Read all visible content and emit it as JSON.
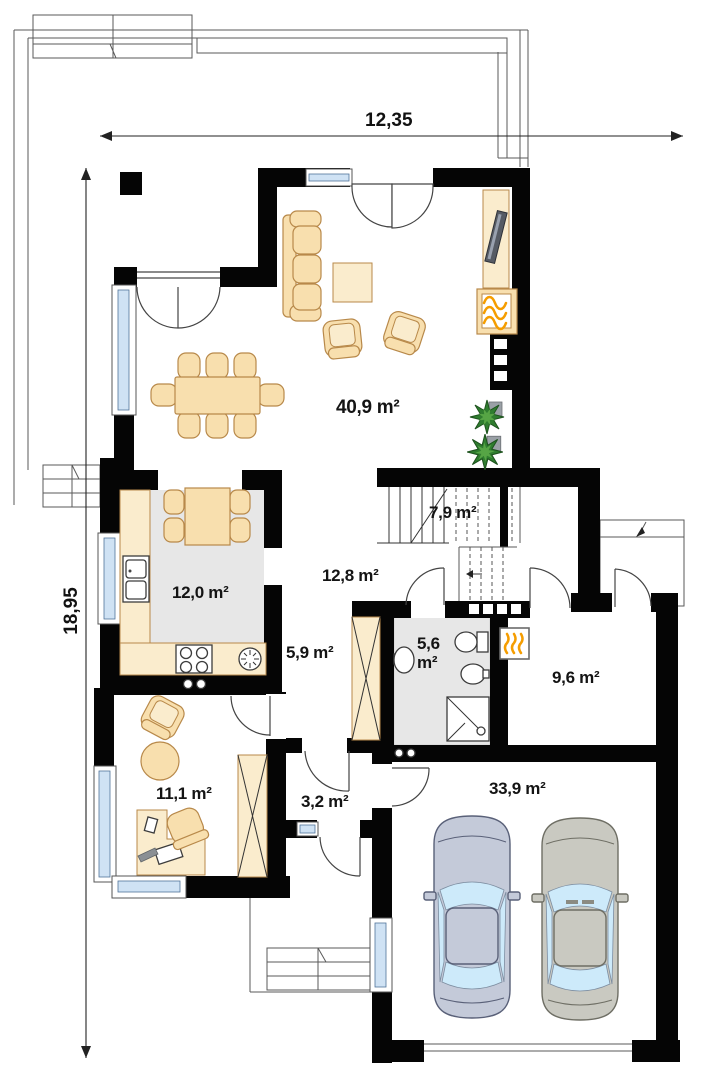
{
  "plan": {
    "type": "floor-plan",
    "dimensions": {
      "width_label": "12,35",
      "height_label": "18,95"
    },
    "rooms": [
      {
        "name": "living-room",
        "label": "40,9 m²"
      },
      {
        "name": "staircase",
        "label": "7,9 m²"
      },
      {
        "name": "hall",
        "label": "12,8 m²"
      },
      {
        "name": "kitchen",
        "label": "12,0 m²"
      },
      {
        "name": "corridor",
        "label": "5,9 m²"
      },
      {
        "name": "bathroom",
        "label": "5,6",
        "label2": "m²"
      },
      {
        "name": "utility-room",
        "label": "9,6 m²"
      },
      {
        "name": "office",
        "label": "11,1 m²"
      },
      {
        "name": "vestibule",
        "label": "3,2 m²"
      },
      {
        "name": "garage",
        "label": "33,9 m²"
      }
    ],
    "icons": [
      "fireplace-icon",
      "furnace-icon",
      "plant-icon",
      "stove-icon",
      "extractor-fan-icon",
      "sink-icon",
      "washbasin-icon",
      "toilet-icon",
      "bidet-icon",
      "shower-icon",
      "tv-icon",
      "stairs-icon",
      "car-icon",
      "roof-slope-arrow-icon"
    ]
  },
  "colors": {
    "wall": "#050505",
    "floor_gray": "#e7e7e7",
    "furniture_fill": "#f8dfae",
    "furniture_stroke": "#b8894a",
    "glass": "#cfe2f4",
    "flame": "#f59d00",
    "plant": "#2f7d2f",
    "car1": "#c4cad9",
    "car2": "#c9c9c1"
  }
}
